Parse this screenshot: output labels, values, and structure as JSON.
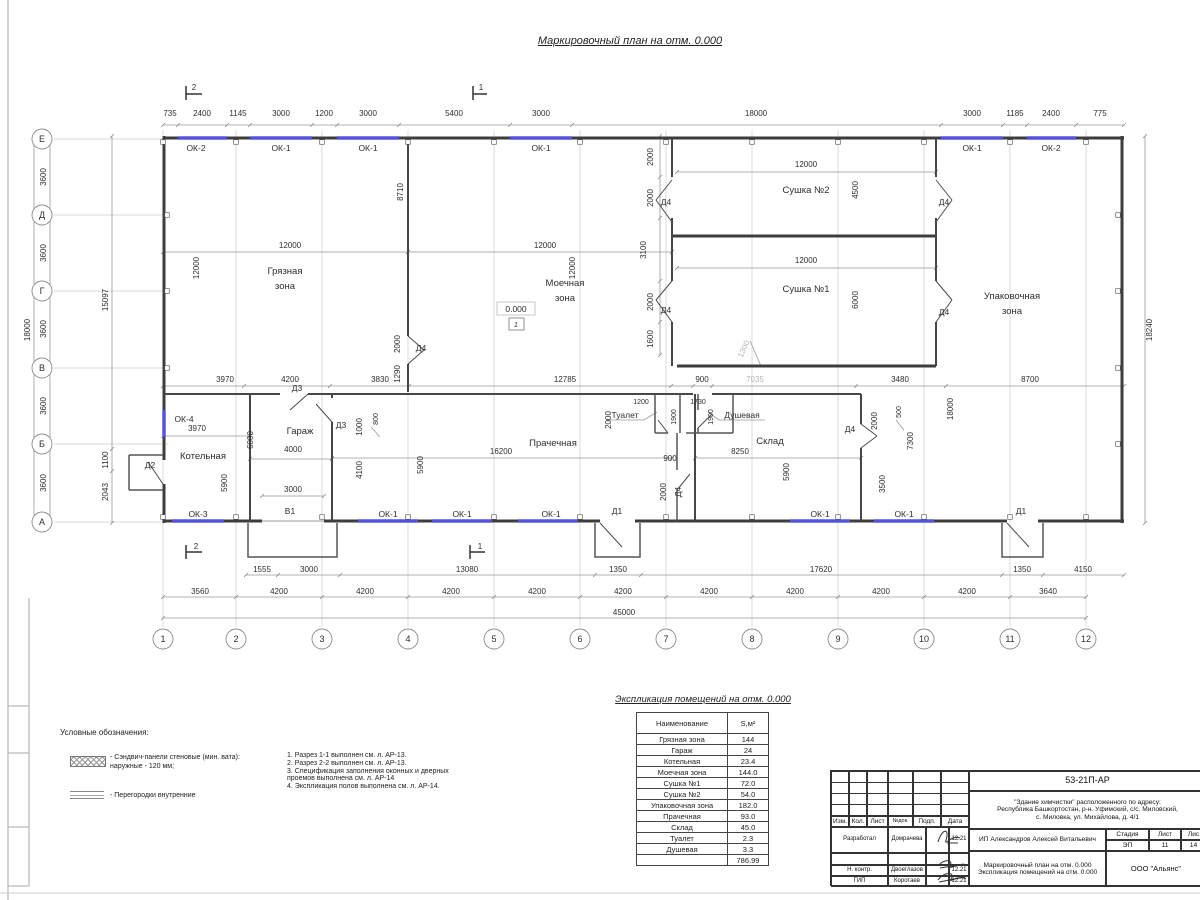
{
  "title": "Маркировочный план на отм. 0.000",
  "axis": {
    "rows": [
      "Е",
      "Д",
      "Г",
      "В",
      "Б",
      "А"
    ],
    "cols": [
      "1",
      "2",
      "3",
      "4",
      "5",
      "6",
      "7",
      "8",
      "9",
      "10",
      "11",
      "12"
    ]
  },
  "op": {
    "ok1": "ОК-1",
    "ok2": "ОК-2",
    "ok3": "ОК-3",
    "ok4": "ОК-4",
    "d1": "Д1",
    "d2": "Д2",
    "d3": "Д3",
    "d4": "Д4",
    "v1": "В1"
  },
  "rooms": {
    "gr1": "Грязная",
    "gr2": "зона",
    "mo1": "Моечная",
    "mo2": "зона",
    "su2": "Сушка №2",
    "su1": "Сушка №1",
    "up1": "Упаковочная",
    "up2": "зона",
    "kot": "Котельная",
    "gar": "Гараж",
    "pra": "Прачечная",
    "tua": "Туалет",
    "dus": "Душевая",
    "skl": "Склад"
  },
  "elev": {
    "value": "0.000",
    "mark": "1"
  },
  "sec": {
    "one": "1",
    "two": "2"
  },
  "dim": {
    "top": [
      "735",
      "2400",
      "1145",
      "3000",
      "1200",
      "3000",
      "5400",
      "3000",
      "18000",
      "3000",
      "1185",
      "2400",
      "775"
    ],
    "bd": [
      "1555",
      "3000",
      "13080",
      "1350",
      "17620",
      "1350",
      "4150"
    ],
    "bc": [
      "3560",
      "4200",
      "4200",
      "4200",
      "4200",
      "4200",
      "4200",
      "4200",
      "4200",
      "4200",
      "3640"
    ],
    "total": "45000",
    "l36": "3600",
    "l18": "18000",
    "l15097": "15097",
    "l1100": "1100",
    "l2043": "2043",
    "r18240": "18240",
    "gzw": "12000",
    "gzh": "12000",
    "w8710": "8710",
    "mzw": "12000",
    "mzh": "12000",
    "s2w": "12000",
    "s2h": "4500",
    "s1w": "12000",
    "s1h": "6000",
    "sc": [
      "2000",
      "2000",
      "3100",
      "2000",
      "1600"
    ],
    "dmz1": "2000",
    "dmz2": "1290",
    "b3970": "3970",
    "b4200": "4200",
    "b3830": "3830",
    "b12785": "12785",
    "b900": "900",
    "b7035": "7035",
    "b3480": "3480",
    "b8700": "8700",
    "g1300": "1300",
    "ok4w": "3970",
    "k6000": "6000",
    "k5900": "5900",
    "g4000": "4000",
    "g1000": "1000",
    "g800": "800",
    "g3000": "3000",
    "g4100": "4100",
    "p5900": "5900",
    "p16200": "16200",
    "p2000": "2000",
    "t1200": "1200",
    "d1730": "1730",
    "t1900": "1900",
    "c900": "900",
    "c2000": "2000",
    "s8250": "8250",
    "s5900": "5900",
    "r2000": "2000",
    "r500": "500",
    "r3500": "3500",
    "r7300": "7300",
    "r18000": "18000"
  },
  "table": {
    "title": "Экспликация помещений на отм. 0.000",
    "h1": "Наименование",
    "h2": "S,м²",
    "rows": [
      [
        "Грязная зона",
        "144"
      ],
      [
        "Гараж",
        "24"
      ],
      [
        "Котельная",
        "23.4"
      ],
      [
        "Моечная зона",
        "144.0"
      ],
      [
        "Сушка №1",
        "72.0"
      ],
      [
        "Сушка №2",
        "54.0"
      ],
      [
        "Упаковочная зона",
        "182.0"
      ],
      [
        "Прачечная",
        "93.0"
      ],
      [
        "Склад",
        "45.0"
      ],
      [
        "Туалет",
        "2.3"
      ],
      [
        "Душевая",
        "3.3"
      ]
    ],
    "total": "786.99"
  },
  "legend": {
    "title": "Условные обозначения:",
    "i1a": "- Сэндвич-панели стеновые (мин. вата):",
    "i1b": "наружные - 120 мм;",
    "i2": "- Перегородки внутренние"
  },
  "notes": [
    "1. Разрез 1-1 выполнен см. л. АР-13.",
    "2. Разрез 2-2 выполнен см. л. АР-13.",
    "3. Спецификация заполнения оконных и дверных",
    "проемов выполнена см. л. АР-14",
    "4. Экспликация полов выполнена см. л. АР-14."
  ],
  "tb": {
    "code": "53-21П-АР",
    "addr1": "\"Здание химчистки\" расположенного по адресу:",
    "addr2": "Республика Башкортостан, р-н. Уфимский, с/с. Миловский,",
    "addr3": "с. Миловка, ул. Михайлова, д. 4/1",
    "h_izm": "Изм.",
    "h_kol": "Кол.",
    "h_list": "Лист",
    "h_ndok": "№док.",
    "h_podp": "Подп.",
    "h_data": "Дата",
    "r1_role": "Разработал",
    "r1_name": "Домрачева",
    "r2_role": "Н. контр.",
    "r2_name": "Двоеглазов",
    "r3_role": "ГИП",
    "r3_name": "Коротаев",
    "date": "12.21",
    "client": "ИП Александров Алексей Витальевич",
    "h_stage": "Стадия",
    "h_sheet": "Лист",
    "h_sheets": "Лис",
    "stage": "ЭП",
    "sheet": "11",
    "sheets": "14",
    "doc1": "Маркировочный план на отм. 0.000",
    "doc2": "Экспликация помещений на отм. 0.000",
    "org": "ООО \"Альянс\""
  }
}
